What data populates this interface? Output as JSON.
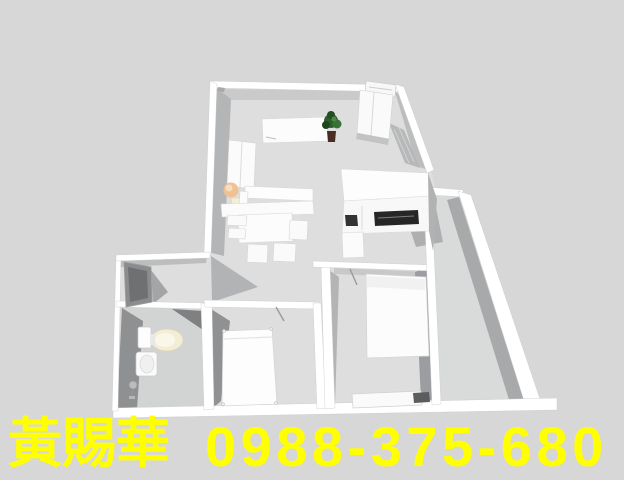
{
  "watermark": {
    "name": "黃賜華",
    "phone": "0988-375-680",
    "color": "#ffff00"
  },
  "scene": {
    "type": "3d-floorplan-render",
    "rooms": [
      "living-dining",
      "kitchen",
      "entry-hall",
      "bathroom",
      "bedroom-1",
      "bedroom-2",
      "side-corridor"
    ]
  },
  "palette": {
    "background": "#d7d7d7",
    "floor": "#dedede",
    "wall": "#ffffff",
    "wall_shade": "#b3b5b6",
    "deep_shade": "#8f9193",
    "stove": "#262626",
    "plant_green": "#2d5f2a",
    "lamp_peach": "#efc194",
    "toilet_seat": "#f3edd6",
    "watermark_yellow": "#ffff00"
  }
}
